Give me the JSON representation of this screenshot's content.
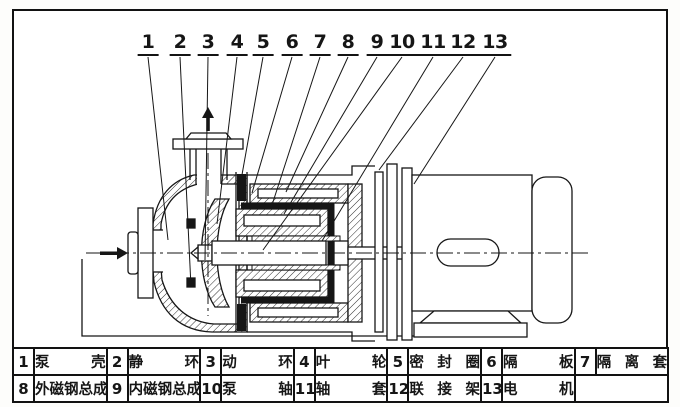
{
  "colors": {
    "ink": "#161616",
    "paper": "#ffffff"
  },
  "icons": {
    "inlet_flow": "right-arrow-icon",
    "outlet_flow": "up-arrow-icon"
  },
  "callouts": {
    "items": [
      {
        "num": "1"
      },
      {
        "num": "2"
      },
      {
        "num": "3"
      },
      {
        "num": "4"
      },
      {
        "num": "5"
      },
      {
        "num": "6"
      },
      {
        "num": "7"
      },
      {
        "num": "8"
      },
      {
        "num": "9"
      },
      {
        "num": "10"
      },
      {
        "num": "11"
      },
      {
        "num": "12"
      },
      {
        "num": "13"
      }
    ]
  },
  "parts_table": {
    "rows": [
      [
        {
          "num": "1",
          "name": "泵壳"
        },
        {
          "num": "2",
          "name": "静环"
        },
        {
          "num": "3",
          "name": "动环"
        },
        {
          "num": "4",
          "name": "叶轮"
        },
        {
          "num": "5",
          "name": "密封圈"
        },
        {
          "num": "6",
          "name": "隔板"
        },
        {
          "num": "7",
          "name": "隔离套"
        }
      ],
      [
        {
          "num": "8",
          "name": "外磁钢总成"
        },
        {
          "num": "9",
          "name": "内磁钢总成"
        },
        {
          "num": "10",
          "name": "泵轴"
        },
        {
          "num": "11",
          "name": "轴套"
        },
        {
          "num": "12",
          "name": "联接架"
        },
        {
          "num": "13",
          "name": "电机"
        },
        {
          "num": "",
          "name": ""
        }
      ]
    ]
  }
}
